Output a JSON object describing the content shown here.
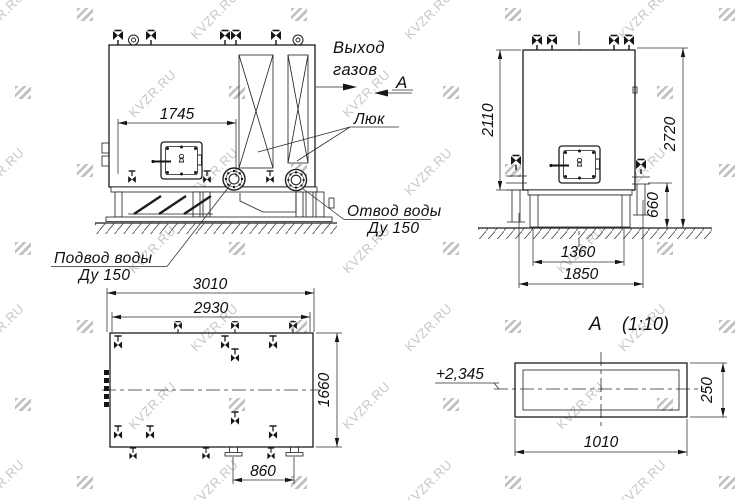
{
  "drawing": {
    "labels": {
      "gas_outlet": {
        "line1": "Выход",
        "line2": "газов"
      },
      "view_arrow_letter": "А",
      "hatch": "Люк",
      "water_outlet": {
        "line1": "Отвод воды",
        "line2": "Ду 150"
      },
      "water_inlet": {
        "line1": "Подвод воды",
        "line2": "Ду 150"
      },
      "section_view": {
        "letter": "А",
        "scale": "(1:10)"
      },
      "level_mark": "+2,345"
    },
    "dimensions": {
      "front_width": "1745",
      "side_body_height": "2110",
      "side_overall_height": "2720",
      "side_frame_height": "660",
      "side_frame_width": "1360",
      "side_overall_width": "1850",
      "plan_overall_length": "3010",
      "plan_body_length": "2930",
      "plan_width": "1660",
      "plan_nozzle_spacing": "860",
      "section_width": "1010",
      "section_height": "250"
    }
  },
  "watermark": {
    "text": "KVZR.RU"
  },
  "colors": {
    "line": "#1d1d1d",
    "watermark": "#c7c7c7",
    "background": "#ffffff"
  }
}
